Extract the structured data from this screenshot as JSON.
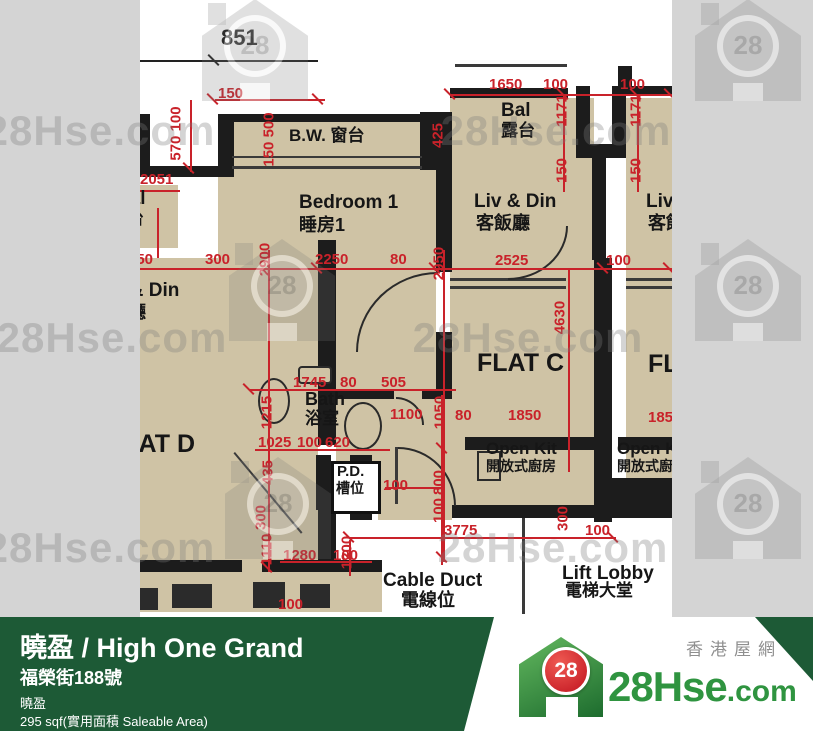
{
  "colors": {
    "accent_red": "#c9222a",
    "wall_black": "#1c1c1c",
    "floor_tan": "#cfc3a5",
    "footer_green": "#1d5a36",
    "logo_green": "#2f9440",
    "logo_red": "#d21f2b",
    "background_gray": "#d4d4d4"
  },
  "watermark": {
    "text": "28Hse.com",
    "badge": "28",
    "houses": [
      {
        "x": 255,
        "y": 50
      },
      {
        "x": 748,
        "y": 50
      },
      {
        "x": 282,
        "y": 290
      },
      {
        "x": 748,
        "y": 290
      },
      {
        "x": 278,
        "y": 508
      },
      {
        "x": 748,
        "y": 508
      }
    ],
    "texts": [
      {
        "x": 100,
        "y": 131
      },
      {
        "x": 556,
        "y": 131
      },
      {
        "x": 112,
        "y": 338
      },
      {
        "x": 528,
        "y": 338
      },
      {
        "x": 100,
        "y": 548
      },
      {
        "x": 553,
        "y": 548
      }
    ]
  },
  "plan": {
    "room_labels": [
      {
        "t": "851",
        "l": 221,
        "tp": 27,
        "fs": 22
      },
      {
        "t": "B.W. 窗台",
        "l": 289,
        "tp": 127,
        "fs": 17
      },
      {
        "t": "Bedroom 1",
        "l": 299,
        "tp": 193,
        "fs": 19
      },
      {
        "t": "睡房1",
        "l": 299,
        "tp": 216,
        "fs": 18
      },
      {
        "t": "Bal",
        "l": 501,
        "tp": 101,
        "fs": 19
      },
      {
        "t": "露台",
        "l": 501,
        "tp": 122,
        "fs": 17
      },
      {
        "t": "Liv & Din",
        "l": 474,
        "tp": 192,
        "fs": 19
      },
      {
        "t": "客飯廳",
        "l": 476,
        "tp": 214,
        "fs": 18
      },
      {
        "t": "Liv & Din",
        "l": 646,
        "tp": 192,
        "fs": 19
      },
      {
        "t": "客飯廳",
        "l": 648,
        "tp": 214,
        "fs": 18
      },
      {
        "t": "Bal",
        "l": 116,
        "tp": 189,
        "fs": 19
      },
      {
        "t": "露台",
        "l": 110,
        "tp": 210,
        "fs": 17
      },
      {
        "t": "Liv & Din",
        "l": 97,
        "tp": 281,
        "fs": 19
      },
      {
        "t": "客飯廳",
        "l": 92,
        "tp": 303,
        "fs": 18
      },
      {
        "t": "FLAT D",
        "l": 108,
        "tp": 432,
        "fs": 25
      },
      {
        "t": "FLAT C",
        "l": 477,
        "tp": 351,
        "fs": 25
      },
      {
        "t": "FLAT",
        "l": 648,
        "tp": 352,
        "fs": 25
      },
      {
        "t": "Bath",
        "l": 305,
        "tp": 390,
        "fs": 18
      },
      {
        "t": "浴室",
        "l": 305,
        "tp": 410,
        "fs": 17
      },
      {
        "t": "Open Kit",
        "l": 486,
        "tp": 440,
        "fs": 17
      },
      {
        "t": "開放式廚房",
        "l": 486,
        "tp": 459,
        "fs": 14
      },
      {
        "t": "Open K",
        "l": 617,
        "tp": 440,
        "fs": 17
      },
      {
        "t": "開放式廚",
        "l": 617,
        "tp": 459,
        "fs": 14
      },
      {
        "t": "P.D.",
        "l": 337,
        "tp": 464,
        "fs": 15
      },
      {
        "t": "槽位",
        "l": 336,
        "tp": 481,
        "fs": 14
      },
      {
        "t": "Cable Duct",
        "l": 383,
        "tp": 571,
        "fs": 19
      },
      {
        "t": "電線位",
        "l": 401,
        "tp": 591,
        "fs": 18
      },
      {
        "t": "Lift Lobby",
        "l": 562,
        "tp": 564,
        "fs": 19
      },
      {
        "t": "電梯大堂",
        "l": 565,
        "tp": 582,
        "fs": 17
      }
    ],
    "dims_h": [
      {
        "t": "150",
        "l": 218,
        "tp": 86
      },
      {
        "t": "1650",
        "l": 489,
        "tp": 77
      },
      {
        "t": "100",
        "l": 543,
        "tp": 77
      },
      {
        "t": "100",
        "l": 620,
        "tp": 77
      },
      {
        "t": "2051",
        "l": 140,
        "tp": 172
      },
      {
        "t": "150",
        "l": 128,
        "tp": 252
      },
      {
        "t": "300",
        "l": 205,
        "tp": 252
      },
      {
        "t": "2250",
        "l": 315,
        "tp": 252
      },
      {
        "t": "80",
        "l": 390,
        "tp": 252
      },
      {
        "t": "2525",
        "l": 495,
        "tp": 253
      },
      {
        "t": "100",
        "l": 606,
        "tp": 253
      },
      {
        "t": "1745",
        "l": 293,
        "tp": 375
      },
      {
        "t": "80",
        "l": 340,
        "tp": 375
      },
      {
        "t": "505",
        "l": 381,
        "tp": 375
      },
      {
        "t": "1100",
        "l": 390,
        "tp": 407
      },
      {
        "t": "80",
        "l": 455,
        "tp": 408
      },
      {
        "t": "1850",
        "l": 508,
        "tp": 408
      },
      {
        "t": "1025",
        "l": 258,
        "tp": 435
      },
      {
        "t": "100",
        "l": 297,
        "tp": 435
      },
      {
        "t": "620",
        "l": 325,
        "tp": 435
      },
      {
        "t": "100",
        "l": 383,
        "tp": 478
      },
      {
        "t": "1280",
        "l": 283,
        "tp": 548
      },
      {
        "t": "100",
        "l": 333,
        "tp": 548
      },
      {
        "t": "3775",
        "l": 444,
        "tp": 523
      },
      {
        "t": "100",
        "l": 585,
        "tp": 523
      },
      {
        "t": "100",
        "l": 278,
        "tp": 597
      },
      {
        "t": "1850",
        "l": 648,
        "tp": 410
      }
    ],
    "dims_v": [
      {
        "t": "570 100",
        "x": 176,
        "y": 134
      },
      {
        "t": "150 500",
        "x": 269,
        "y": 140
      },
      {
        "t": "425",
        "x": 438,
        "y": 136
      },
      {
        "t": "1171",
        "x": 562,
        "y": 111
      },
      {
        "t": "1171",
        "x": 636,
        "y": 111
      },
      {
        "t": "150",
        "x": 562,
        "y": 171
      },
      {
        "t": "150",
        "x": 636,
        "y": 171
      },
      {
        "t": "2900",
        "x": 265,
        "y": 260
      },
      {
        "t": "2950",
        "x": 439,
        "y": 264
      },
      {
        "t": "4630",
        "x": 560,
        "y": 318
      },
      {
        "t": "1215",
        "x": 267,
        "y": 413
      },
      {
        "t": "1050",
        "x": 440,
        "y": 413
      },
      {
        "t": "435",
        "x": 268,
        "y": 473
      },
      {
        "t": "800",
        "x": 439,
        "y": 483
      },
      {
        "t": "100",
        "x": 439,
        "y": 511
      },
      {
        "t": "300",
        "x": 261,
        "y": 518
      },
      {
        "t": "1110",
        "x": 267,
        "y": 550
      },
      {
        "t": "300",
        "x": 563,
        "y": 519
      },
      {
        "t": "1200",
        "x": 347,
        "y": 553
      }
    ]
  },
  "footer": {
    "title": "曉盈 / High One Grand",
    "address": "福榮街188號",
    "estate": "曉盈",
    "area": "295 sqf(實用面積 Saleable Area)"
  },
  "logo": {
    "brand_prefix": "28Hse",
    "brand_suffix": ".com",
    "badge": "28",
    "tagline": "香港屋網"
  }
}
